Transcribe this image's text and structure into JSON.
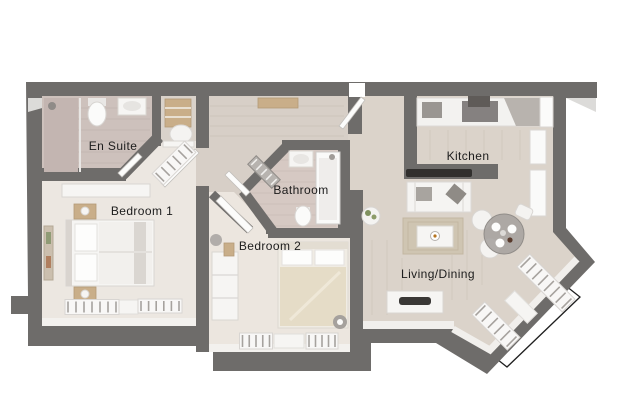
{
  "plan": {
    "type": "apartment-floor-plan",
    "view": "top-down-3d-render"
  },
  "palette": {
    "wall": "#6e6c6a",
    "carpet_bedroom1": "#ece7e1",
    "carpet_bedroom2": "#ece6df",
    "tile_ensuite": "#cdc1bc",
    "tile_bathroom": "#d6c9c3",
    "wood_floor": "#d9d1c8",
    "wood_floor_light": "#dbd3ca",
    "furniture_white": "#f6f5f3",
    "furniture_tan": "#c9ae89",
    "label_text": "#1c1c1c",
    "background": "#ffffff"
  },
  "rooms": [
    {
      "id": "en-suite",
      "label": "En Suite"
    },
    {
      "id": "bedroom-1",
      "label": "Bedroom 1"
    },
    {
      "id": "bathroom",
      "label": "Bathroom"
    },
    {
      "id": "bedroom-2",
      "label": "Bedroom 2"
    },
    {
      "id": "kitchen",
      "label": "Kitchen"
    },
    {
      "id": "living-dining",
      "label": "Living/Dining"
    }
  ]
}
